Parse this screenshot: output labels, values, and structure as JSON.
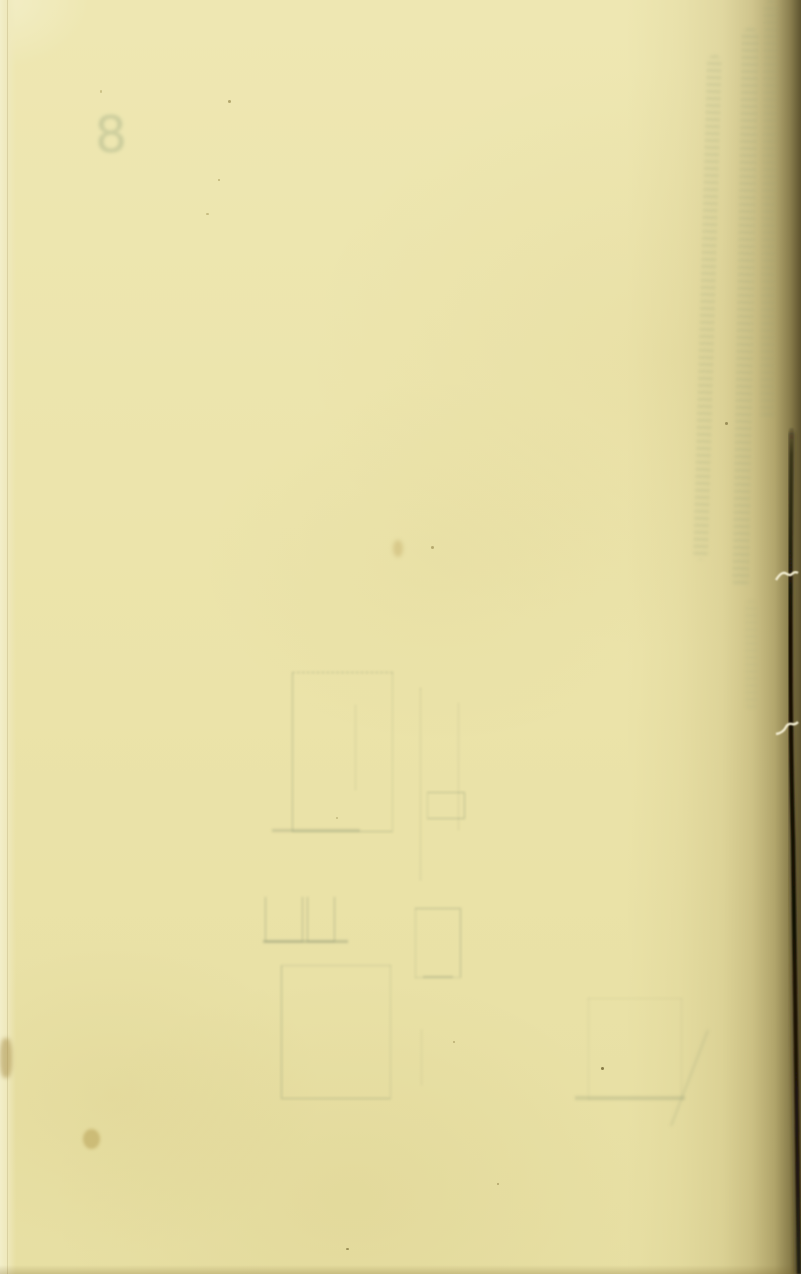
{
  "document": {
    "type": "scanned-book-page",
    "description": "Blank aged verso page of a book scan with faint bleed-through of a diagram and handwriting from the reverse side, dark binding edge at right with two thread stitches",
    "bleed_numeral": "8"
  },
  "colors": {
    "paper_base": "#ece4ab",
    "paper_highlight": "#f2eec9",
    "right_edge_olive": "#8a7a30",
    "binding_line": "#17120a",
    "stitch_thread": "#f2ecd0",
    "bleed_mark": "#96a078",
    "stain_brown": "#b49b5a"
  },
  "artifacts": {
    "specks": [
      {
        "x": 228,
        "y": 100,
        "w": 3,
        "h": 3,
        "color": "#9a8c50",
        "opacity": 0.7
      },
      {
        "x": 218,
        "y": 179,
        "w": 2,
        "h": 2,
        "color": "#a09250",
        "opacity": 0.6
      },
      {
        "x": 206,
        "y": 213,
        "w": 3,
        "h": 2,
        "color": "#a09250",
        "opacity": 0.5
      },
      {
        "x": 100,
        "y": 90,
        "w": 2,
        "h": 3,
        "color": "#a89a58",
        "opacity": 0.5
      },
      {
        "x": 431,
        "y": 546,
        "w": 3,
        "h": 3,
        "color": "#8a7c42",
        "opacity": 0.55
      },
      {
        "x": 725,
        "y": 422,
        "w": 3,
        "h": 3,
        "color": "#6e622f",
        "opacity": 0.6
      },
      {
        "x": 336,
        "y": 817,
        "w": 2,
        "h": 2,
        "color": "#8a7c42",
        "opacity": 0.4
      },
      {
        "x": 601,
        "y": 1067,
        "w": 3,
        "h": 3,
        "color": "#6e622f",
        "opacity": 0.8
      },
      {
        "x": 453,
        "y": 1041,
        "w": 2,
        "h": 2,
        "color": "#8a7c42",
        "opacity": 0.5
      },
      {
        "x": 497,
        "y": 1183,
        "w": 2,
        "h": 2,
        "color": "#8a7c42",
        "opacity": 0.6
      },
      {
        "x": 346,
        "y": 1248,
        "w": 3,
        "h": 2,
        "color": "#7a6d38",
        "opacity": 0.7
      }
    ]
  }
}
